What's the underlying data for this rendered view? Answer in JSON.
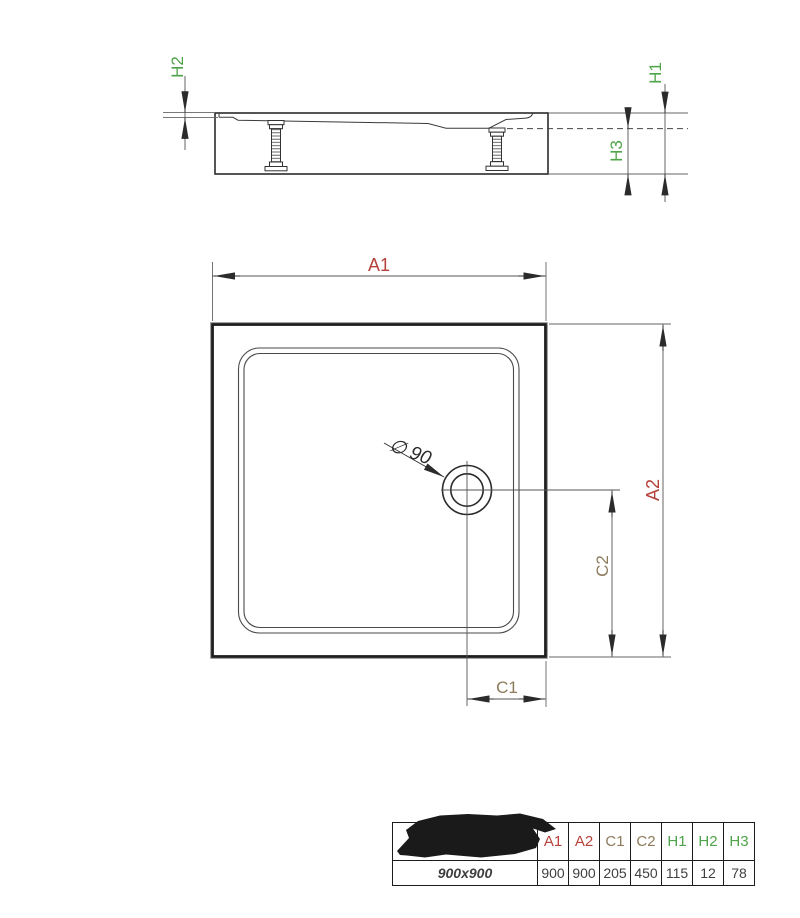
{
  "side_view": {
    "labels": {
      "h1": "H1",
      "h2": "H2",
      "h3": "H3"
    }
  },
  "plan_view": {
    "labels": {
      "a1": "A1",
      "a2": "A2",
      "c1": "C1",
      "c2": "C2"
    },
    "drain_diameter": "∅ 90"
  },
  "colors": {
    "dimension_red": "#b5423a",
    "dimension_brown": "#8d7b5c",
    "dimension_green": "#4fa348",
    "line": "#2b2b2b"
  },
  "spec_table": {
    "model": "900x900",
    "columns": [
      {
        "label": "A1"
      },
      {
        "label": "A2"
      },
      {
        "label": "C1"
      },
      {
        "label": "C2"
      },
      {
        "label": "H1"
      },
      {
        "label": "H2"
      },
      {
        "label": "H3"
      }
    ],
    "values": [
      "900",
      "900",
      "205",
      "450",
      "115",
      "12",
      "78"
    ]
  }
}
